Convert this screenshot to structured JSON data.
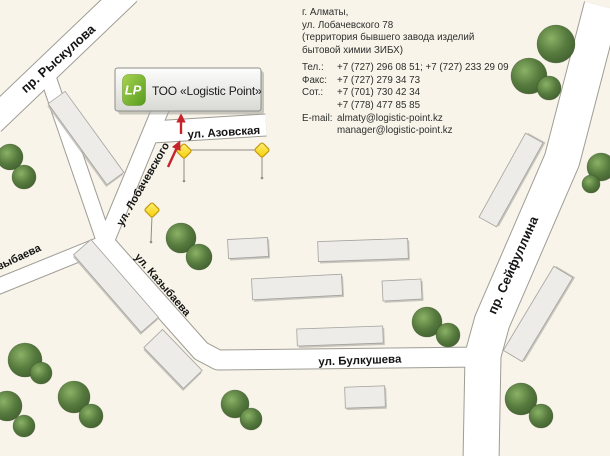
{
  "logo": {
    "title": "ТОО «Logistic Point»",
    "monogram": "LP"
  },
  "contact": {
    "city": "г. Алматы,",
    "address_line": "ул. Лобачевского 78",
    "territory_line1": "(территория бывшего завода изделий",
    "territory_line2": "бытовой химии ЗИБХ)",
    "rows": [
      {
        "label": "Тел.:",
        "value": "+7 (727) 296 08 51; +7 (727) 233 29 09"
      },
      {
        "label": "Факс:",
        "value": "+7 (727) 279 34 73"
      },
      {
        "label": "Сот.:",
        "value": "+7 (701) 730 42 34"
      },
      {
        "label": "",
        "value": "+7 (778) 477 85 85"
      },
      {
        "label": "E-mail:",
        "value": "almaty@logistic-point.kz"
      },
      {
        "label": "",
        "value": "manager@logistic-point.kz"
      }
    ]
  },
  "streets": {
    "ryskulova": "пр. Рыскулова",
    "lobachevskogo": "ул. Лобачевского",
    "azovskaya": "ул. Азовская",
    "kazybaeva_left": "ул. Казыбаева",
    "kazybaeva": "ул. Казыбаева",
    "bulkusheva": "ул. Булкушева",
    "seyfullina": "пр. Сейфуллина"
  },
  "colors": {
    "land": "#F8F4E9",
    "road": "#FFFFFF",
    "road-border": "#9E9C94",
    "building": "#EDECE9",
    "building-border": "#A3A29D",
    "marker-gold": "#FFE02E",
    "marker-gold-border": "#C19A10",
    "accent-red": "#C6242C",
    "tree-green": "#567A3E",
    "logo-green": "#6FB12C"
  }
}
